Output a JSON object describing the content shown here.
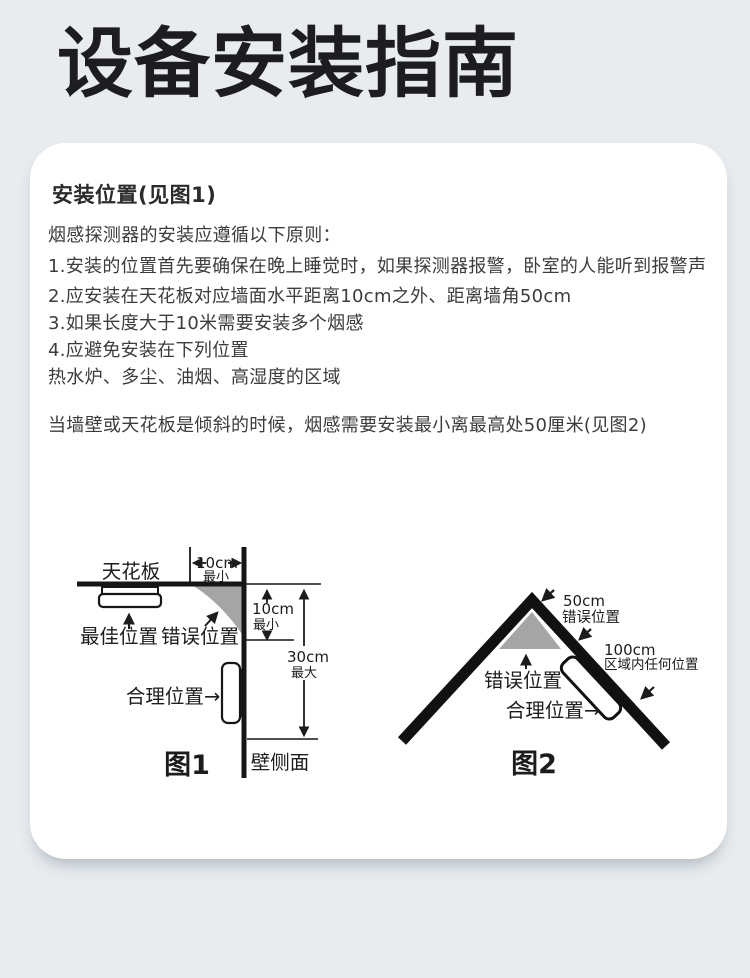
{
  "page": {
    "title": "设备安装指南"
  },
  "colors": {
    "background": "#e8ecef",
    "card": "#ffffff",
    "title_text": "#1d1d1f",
    "body_text": "#3c3c3c",
    "diagram_line": "#161616",
    "wrong_zone_gray": "#a5a5a5"
  },
  "section": {
    "heading": "安装位置(见图1)",
    "intro": "烟感探测器的安装应遵循以下原则：",
    "rules": [
      "1.安装的位置首先要确保在晚上睡觉时，如果探测器报警，卧室的人能听到报警声",
      "2.应安装在天花板对应墙面水平距离10cm之外、距离墙角50cm",
      "3.如果长度大于10米需要安装多个烟感",
      "4.应避免安装在下列位置",
      "热水炉、多尘、油烟、高湿度的区域"
    ],
    "slope_note": "当墙壁或天花板是倾斜的时候，烟感需要安装最小离最高处50厘米(见图2)"
  },
  "figure1": {
    "caption": "图1",
    "labels": {
      "ceiling": "天花板",
      "best_position": "最佳位置",
      "wrong_position": "错误位置",
      "reasonable_position": "合理位置→",
      "wall_side": "壁侧面",
      "top_dim_value": "10cm",
      "top_dim_min": "最小",
      "right_dim_value": "10cm",
      "right_dim_min": "最小",
      "height_dim_value": "30cm",
      "height_dim_max": "最大"
    }
  },
  "figure2": {
    "caption": "图2",
    "labels": {
      "apex_dim_value": "50cm",
      "apex_wrong_position": "错误位置",
      "zone_dim_value": "100cm",
      "zone_anywhere": "区域内任何位置",
      "wrong_position": "错误位置",
      "reasonable_position": "合理位置→"
    }
  }
}
